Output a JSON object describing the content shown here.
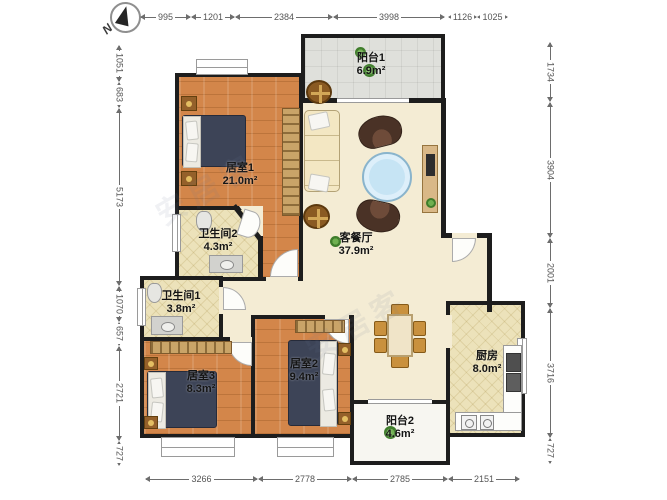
{
  "compass": {
    "label": "N"
  },
  "watermark": {
    "text": "安居客"
  },
  "colors": {
    "wall": "#1d1d1d",
    "wood_floor": "#d3864a",
    "tile_floor": "#ece2ba",
    "living_floor": "#f4ecd4",
    "balcony_floor": "#dfe0db",
    "bed": "#3d4457",
    "coffee_table": "#c6e4f4",
    "plant": "#3f7d2b"
  },
  "rooms": [
    {
      "name": "阳台1",
      "area": "6.9m²"
    },
    {
      "name": "居室1",
      "area": "21.0m²"
    },
    {
      "name": "卫生间2",
      "area": "4.3m²"
    },
    {
      "name": "卫生间1",
      "area": "3.8m²"
    },
    {
      "name": "居室3",
      "area": "8.3m²"
    },
    {
      "name": "居室2",
      "area": "9.4m²"
    },
    {
      "name": "客餐厅",
      "area": "37.9m²"
    },
    {
      "name": "厨房",
      "area": "8.0m²"
    },
    {
      "name": "阳台2",
      "area": "4.6m²"
    }
  ],
  "dimensions": {
    "top": [
      "995",
      "1201",
      "2384",
      "3998",
      "1126",
      "1025"
    ],
    "left": [
      "1051",
      "683",
      "5173",
      "1070",
      "657",
      "2721",
      "727"
    ],
    "right": [
      "1734",
      "3904",
      "2001",
      "3716",
      "727"
    ],
    "bottom": [
      "3266",
      "2778",
      "2785",
      "2151"
    ]
  }
}
